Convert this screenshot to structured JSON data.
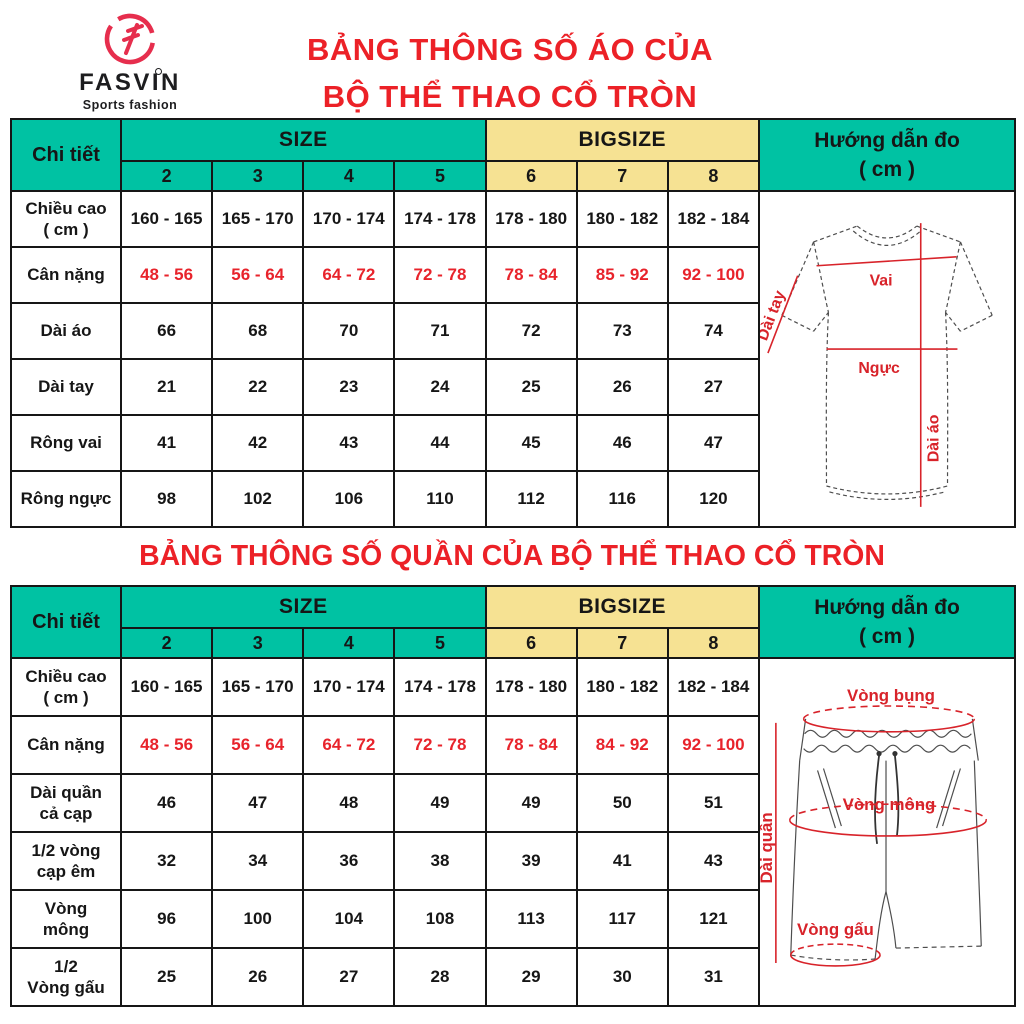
{
  "colors": {
    "teal": "#00C2A3",
    "yellow": "#F6E293",
    "title_red": "#EC2127",
    "value_red": "#E8232B",
    "diagram_red": "#D8232A",
    "logo_red": "#E62E4D",
    "grid_line": "#161616"
  },
  "logo": {
    "brand": "FASVIN",
    "tagline": "Sports fashion",
    "icon": "fasvin-f-circle-icon"
  },
  "shirt_section": {
    "title_line1": "BẢNG THÔNG SỐ ÁO CỦA",
    "title_line2": "BỘ THỂ THAO CỔ TRÒN",
    "table": {
      "corner": "Chi tiết",
      "size": "SIZE",
      "bigsize": "BIGSIZE",
      "guide": "Hướng dẫn đo\n( cm )",
      "sizes": [
        "2",
        "3",
        "4",
        "5",
        "6",
        "7",
        "8"
      ],
      "rows": [
        {
          "label": "Chiều cao\n( cm )",
          "values": [
            "160 - 165",
            "165 - 170",
            "170 - 174",
            "174 - 178",
            "178 - 180",
            "180 - 182",
            "182 - 184"
          ],
          "highlight": false
        },
        {
          "label": "Cân nặng",
          "values": [
            "48 - 56",
            "56 - 64",
            "64 - 72",
            "72 - 78",
            "78 - 84",
            "85 - 92",
            "92 - 100"
          ],
          "highlight": true
        },
        {
          "label": "Dài áo",
          "values": [
            "66",
            "68",
            "70",
            "71",
            "72",
            "73",
            "74"
          ],
          "highlight": false
        },
        {
          "label": "Dài tay",
          "values": [
            "21",
            "22",
            "23",
            "24",
            "25",
            "26",
            "27"
          ],
          "highlight": false
        },
        {
          "label": "Rông vai",
          "values": [
            "41",
            "42",
            "43",
            "44",
            "45",
            "46",
            "47"
          ],
          "highlight": false
        },
        {
          "label": "Rông ngực",
          "values": [
            "98",
            "102",
            "106",
            "110",
            "112",
            "116",
            "120"
          ],
          "highlight": false
        }
      ]
    },
    "diagram_labels": {
      "shoulder": "Vai",
      "sleeve": "Dài tay",
      "chest": "Ngực",
      "length": "Dài áo"
    }
  },
  "pants_section": {
    "title": "BẢNG THÔNG SỐ QUẦN CỦA BỘ THỂ THAO CỔ TRÒN",
    "table": {
      "corner": "Chi tiết",
      "size": "SIZE",
      "bigsize": "BIGSIZE",
      "guide": "Hướng dẫn đo\n( cm )",
      "sizes": [
        "2",
        "3",
        "4",
        "5",
        "6",
        "7",
        "8"
      ],
      "rows": [
        {
          "label": "Chiều cao\n( cm )",
          "values": [
            "160 - 165",
            "165 - 170",
            "170 - 174",
            "174 - 178",
            "178 - 180",
            "180 - 182",
            "182 - 184"
          ],
          "highlight": false
        },
        {
          "label": "Cân nặng",
          "values": [
            "48 - 56",
            "56 - 64",
            "64 - 72",
            "72 - 78",
            "78 - 84",
            "84 - 92",
            "92 - 100"
          ],
          "highlight": true
        },
        {
          "label": "Dài quần\ncả cạp",
          "values": [
            "46",
            "47",
            "48",
            "49",
            "49",
            "50",
            "51"
          ],
          "highlight": false
        },
        {
          "label": "1/2 vòng\ncạp êm",
          "values": [
            "32",
            "34",
            "36",
            "38",
            "39",
            "41",
            "43"
          ],
          "highlight": false
        },
        {
          "label": "Vòng\nmông",
          "values": [
            "96",
            "100",
            "104",
            "108",
            "113",
            "117",
            "121"
          ],
          "highlight": false
        },
        {
          "label": "1/2\nVòng gấu",
          "values": [
            "25",
            "26",
            "27",
            "28",
            "29",
            "30",
            "31"
          ],
          "highlight": false
        }
      ]
    },
    "diagram_labels": {
      "waist": "Vòng bụng",
      "hip": "Vòng mông",
      "length": "Dài quần",
      "hem": "Vòng gấu"
    }
  }
}
